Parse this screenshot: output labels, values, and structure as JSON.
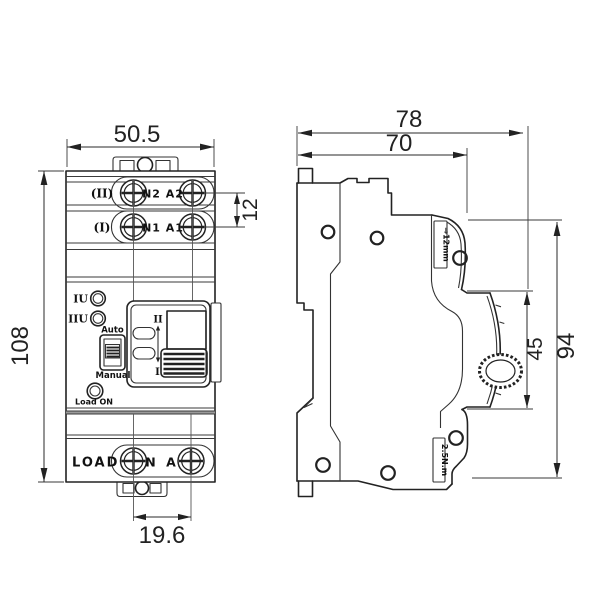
{
  "front_view": {
    "width_dim": "50.5",
    "height_dim": "108",
    "terminal_pitch_dim": "12",
    "load_pitch_dim": "19.6",
    "source2_label": "(II)",
    "source2_terminals": "N2 A2",
    "source1_label": "(I)",
    "source1_terminals": "N1 A1",
    "led_source1_label": "IU",
    "led_source2_label": "IIU",
    "mode_auto_label": "Auto",
    "mode_manual_label": "Manual",
    "load_on_label": "Load ON",
    "position_upper_label": "II",
    "position_lower_label": "I",
    "load_label": "LOAD",
    "load_terminals": "N A"
  },
  "side_view": {
    "depth_total_dim": "78",
    "depth_body_dim": "70",
    "front_height_dim": "94",
    "handle_zone_dim": "45",
    "strip_length_label": "⇒12mm",
    "torque_label": "2.5N.m"
  }
}
